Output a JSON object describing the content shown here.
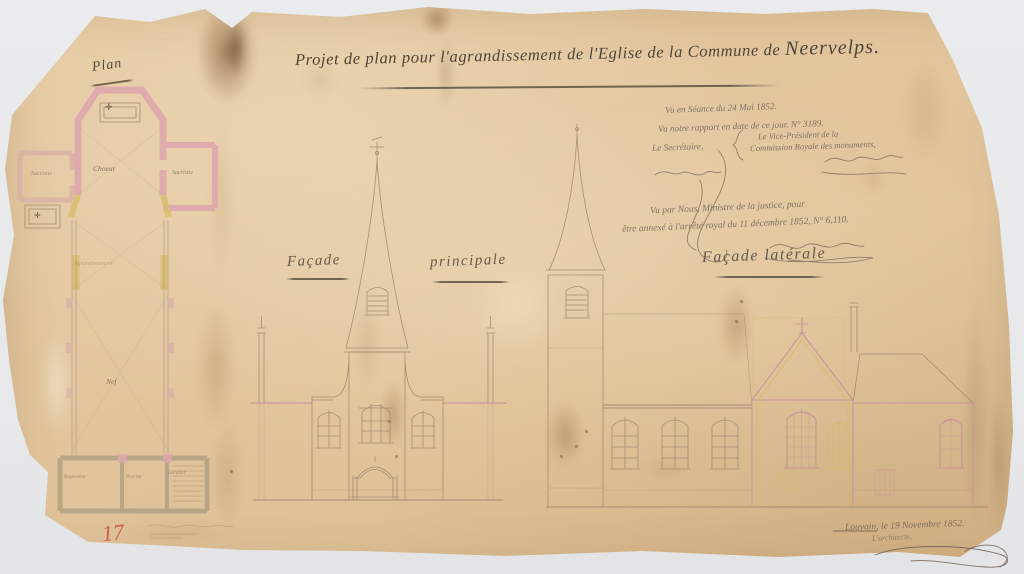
{
  "page": {
    "background_color": "#e9eaec"
  },
  "sheet": {
    "paper_color": "#e2c59d",
    "title": {
      "main": "Projet de plan pour l'agrandissement de l'Eglise de la Commune de",
      "commune": "Neervelps."
    },
    "approval_note": {
      "line1": "Vu en Séance du 24 Mai 1852.",
      "line2": "Vu notre rapport en date de ce jour. N° 3189.",
      "secretary": "Le Secrétaire,",
      "president_line1": "Le Vice-Président de la",
      "president_line2": "Commission Royale des monuments,"
    },
    "minister_note": {
      "line1": "Vu par Nous, Ministre de la justice, pour",
      "line2": "être annexé à l'arrêté royal du 11 décembre 1852, N° 6,110."
    },
    "plan": {
      "label": "Plan",
      "altar_symbol": "✛",
      "rooms": {
        "choir": "Choeur",
        "sacristy_left": "Sacristie",
        "sacristy_right": "Sacristie",
        "crossing": "Agrandissement",
        "nave": "Nef",
        "baptistery": "Baptistère",
        "porch": "Porche",
        "stairs": "Escalier"
      }
    },
    "facades": {
      "principale": {
        "label_left": "Façade",
        "label_right": "principale"
      },
      "laterale": {
        "label": "Façade latérale"
      }
    },
    "footer": {
      "place_date": "Louvain, le 19 Novembre 1852.",
      "architect": "L'architecte,",
      "page_number": "17"
    },
    "legend_colors": {
      "new_construction_pink": "#d89aa0",
      "existing_or_demolition_yellow": "#d9c176",
      "crayon_red": "#c6503c"
    }
  }
}
